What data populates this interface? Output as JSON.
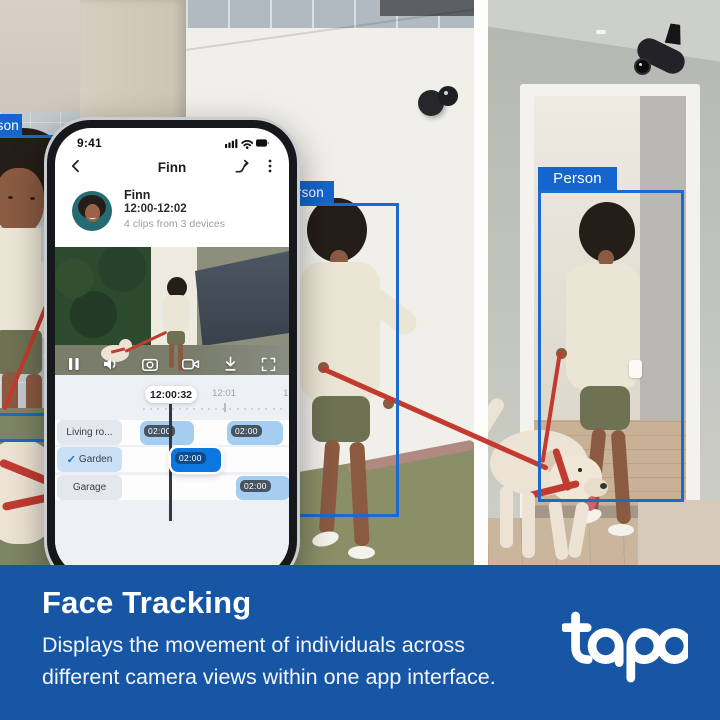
{
  "scene": {
    "person_label": "Person"
  },
  "phone": {
    "status": {
      "time": "9:41"
    },
    "header": {
      "title": "Finn"
    },
    "summary": {
      "name": "Finn",
      "time_range": "12:00-12:02",
      "clips": "4 clips from 3 devices"
    },
    "player": {
      "current_time": "12:00:32"
    },
    "timeline": {
      "ticks": [
        {
          "label": "12:01",
          "x": 169
        },
        {
          "label": "12:02",
          "x": 240
        }
      ],
      "rows": [
        {
          "label": "Living ro...",
          "checked": false,
          "top": 45,
          "clips": [
            {
              "time": "02:00",
              "left": 85,
              "width": 54,
              "selected": false
            },
            {
              "time": "02:00",
              "left": 172,
              "width": 56,
              "selected": false
            }
          ]
        },
        {
          "label": "Garden",
          "checked": true,
          "top": 72,
          "clips": [
            {
              "time": "02:00",
              "left": 116,
              "width": 50,
              "selected": true
            }
          ]
        },
        {
          "label": "Garage",
          "checked": false,
          "top": 100,
          "clips": [
            {
              "time": "02:00",
              "left": 181,
              "width": 54,
              "selected": false
            }
          ]
        }
      ]
    }
  },
  "banner": {
    "title": "Face Tracking",
    "description": [
      "Displays the movement of individuals across",
      "different camera views within one app interface."
    ],
    "logo_text": "tapo"
  },
  "colors": {
    "accent_blue": "#1465cd",
    "box_blue": "#1a6ad0",
    "banner_blue": "#1656a4",
    "clip_blue": "#a5cdf2",
    "clip_selected_blue": "#0d76e0"
  }
}
